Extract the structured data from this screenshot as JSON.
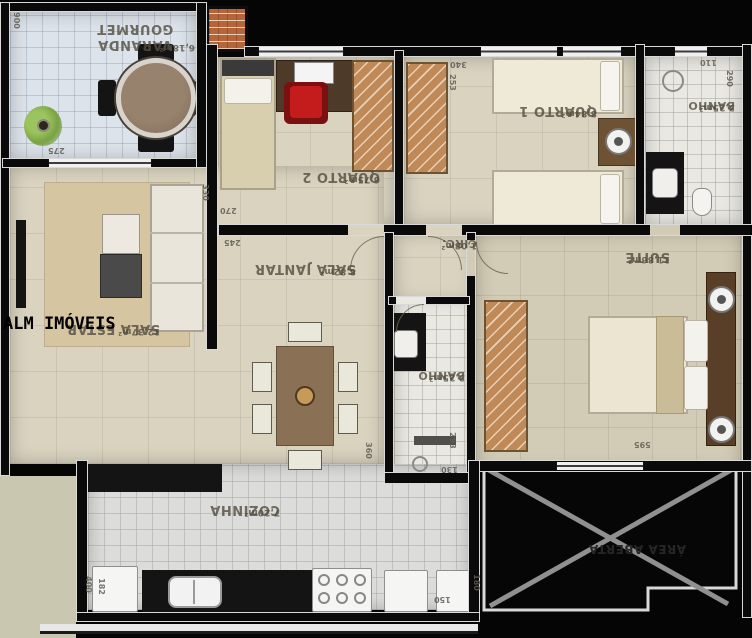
{
  "watermark": "ALM IMÓVEIS",
  "rooms": [
    {
      "name": "VARANDA GOURMET",
      "area": "6,18m²"
    },
    {
      "name": "QUARTO 2",
      "area": "6,75m²"
    },
    {
      "name": "QUARTO 1",
      "area": "8,84m²"
    },
    {
      "name": "BANHO",
      "area": "3,25m²"
    },
    {
      "name": "SALA ESTAR",
      "area": "12,37m²"
    },
    {
      "name": "SALA JANTAR",
      "area": "8,82m²"
    },
    {
      "name": "CIRC.",
      "area": "1,08m²"
    },
    {
      "name": "BANHO",
      "area": "3,25m²"
    },
    {
      "name": "SUITE",
      "area": "11,86m²"
    },
    {
      "name": "COZINHA",
      "area": "7,20m²"
    },
    {
      "name": "ÁREA ABERTA",
      "area": ""
    }
  ],
  "dimensions": [
    "900",
    "275",
    "330",
    "270",
    "340",
    "253",
    "110",
    "290",
    "245",
    "360",
    "293",
    "130",
    "595",
    "400",
    "182",
    "150",
    "180"
  ],
  "colors": {
    "background": "#050505",
    "wall": "#0a0a0a",
    "wall_edge": "#d9d9d9",
    "floor_balcony": "#dde3ea",
    "floor_beige": "#d9d3bf",
    "floor_bath": "#eae8e2",
    "floor_kitchen": "#dcdcda",
    "wardrobe_wood": "#c08a58",
    "table_wood": "#8a7156",
    "desk_chair_red": "#c41c1c",
    "label_text": "#544f42",
    "cross_gray": "#909090"
  }
}
